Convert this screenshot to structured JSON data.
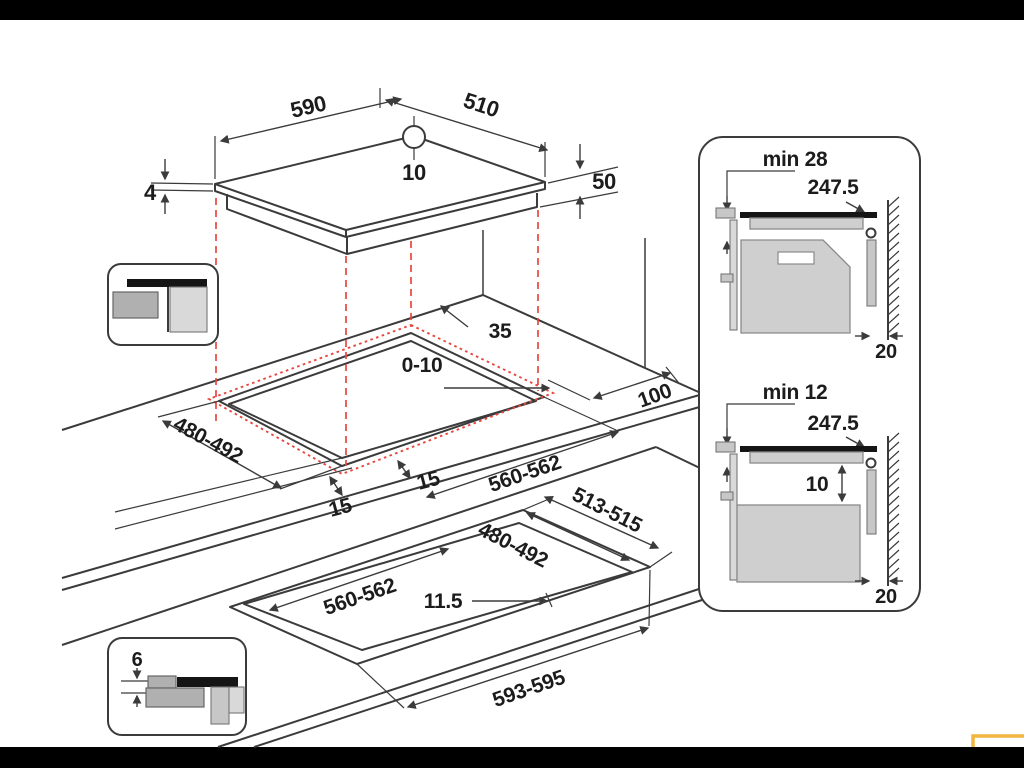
{
  "colors": {
    "line": "#3b3b3b",
    "dashed_red": "#e8473f",
    "accent_yellow": "#f2b63e",
    "bar": "#000000"
  },
  "iso_hob": {
    "width": "590",
    "depth": "510",
    "center_offset": "10",
    "glass_thickness": "4",
    "body_height": "50"
  },
  "iso_cutout": {
    "rear_clearance": "35",
    "edge_overlap": "0-10",
    "depth_range": "480-492",
    "width_range": "560-562",
    "front_clearance_left": "15",
    "front_clearance_right": "15",
    "side_clearance": "100"
  },
  "iso_flush": {
    "outer_depth": "513-515",
    "inner_depth": "480-492",
    "inner_width": "560-562",
    "step_width": "11.5",
    "outer_width": "593-595",
    "recess_depth": "6"
  },
  "panel_oven": {
    "min_clearance": "min 28",
    "install_depth": "247.5",
    "wall_gap": "20"
  },
  "panel_drawer": {
    "min_clearance": "min 12",
    "install_depth": "247.5",
    "clearance_below": "10",
    "wall_gap": "20"
  }
}
